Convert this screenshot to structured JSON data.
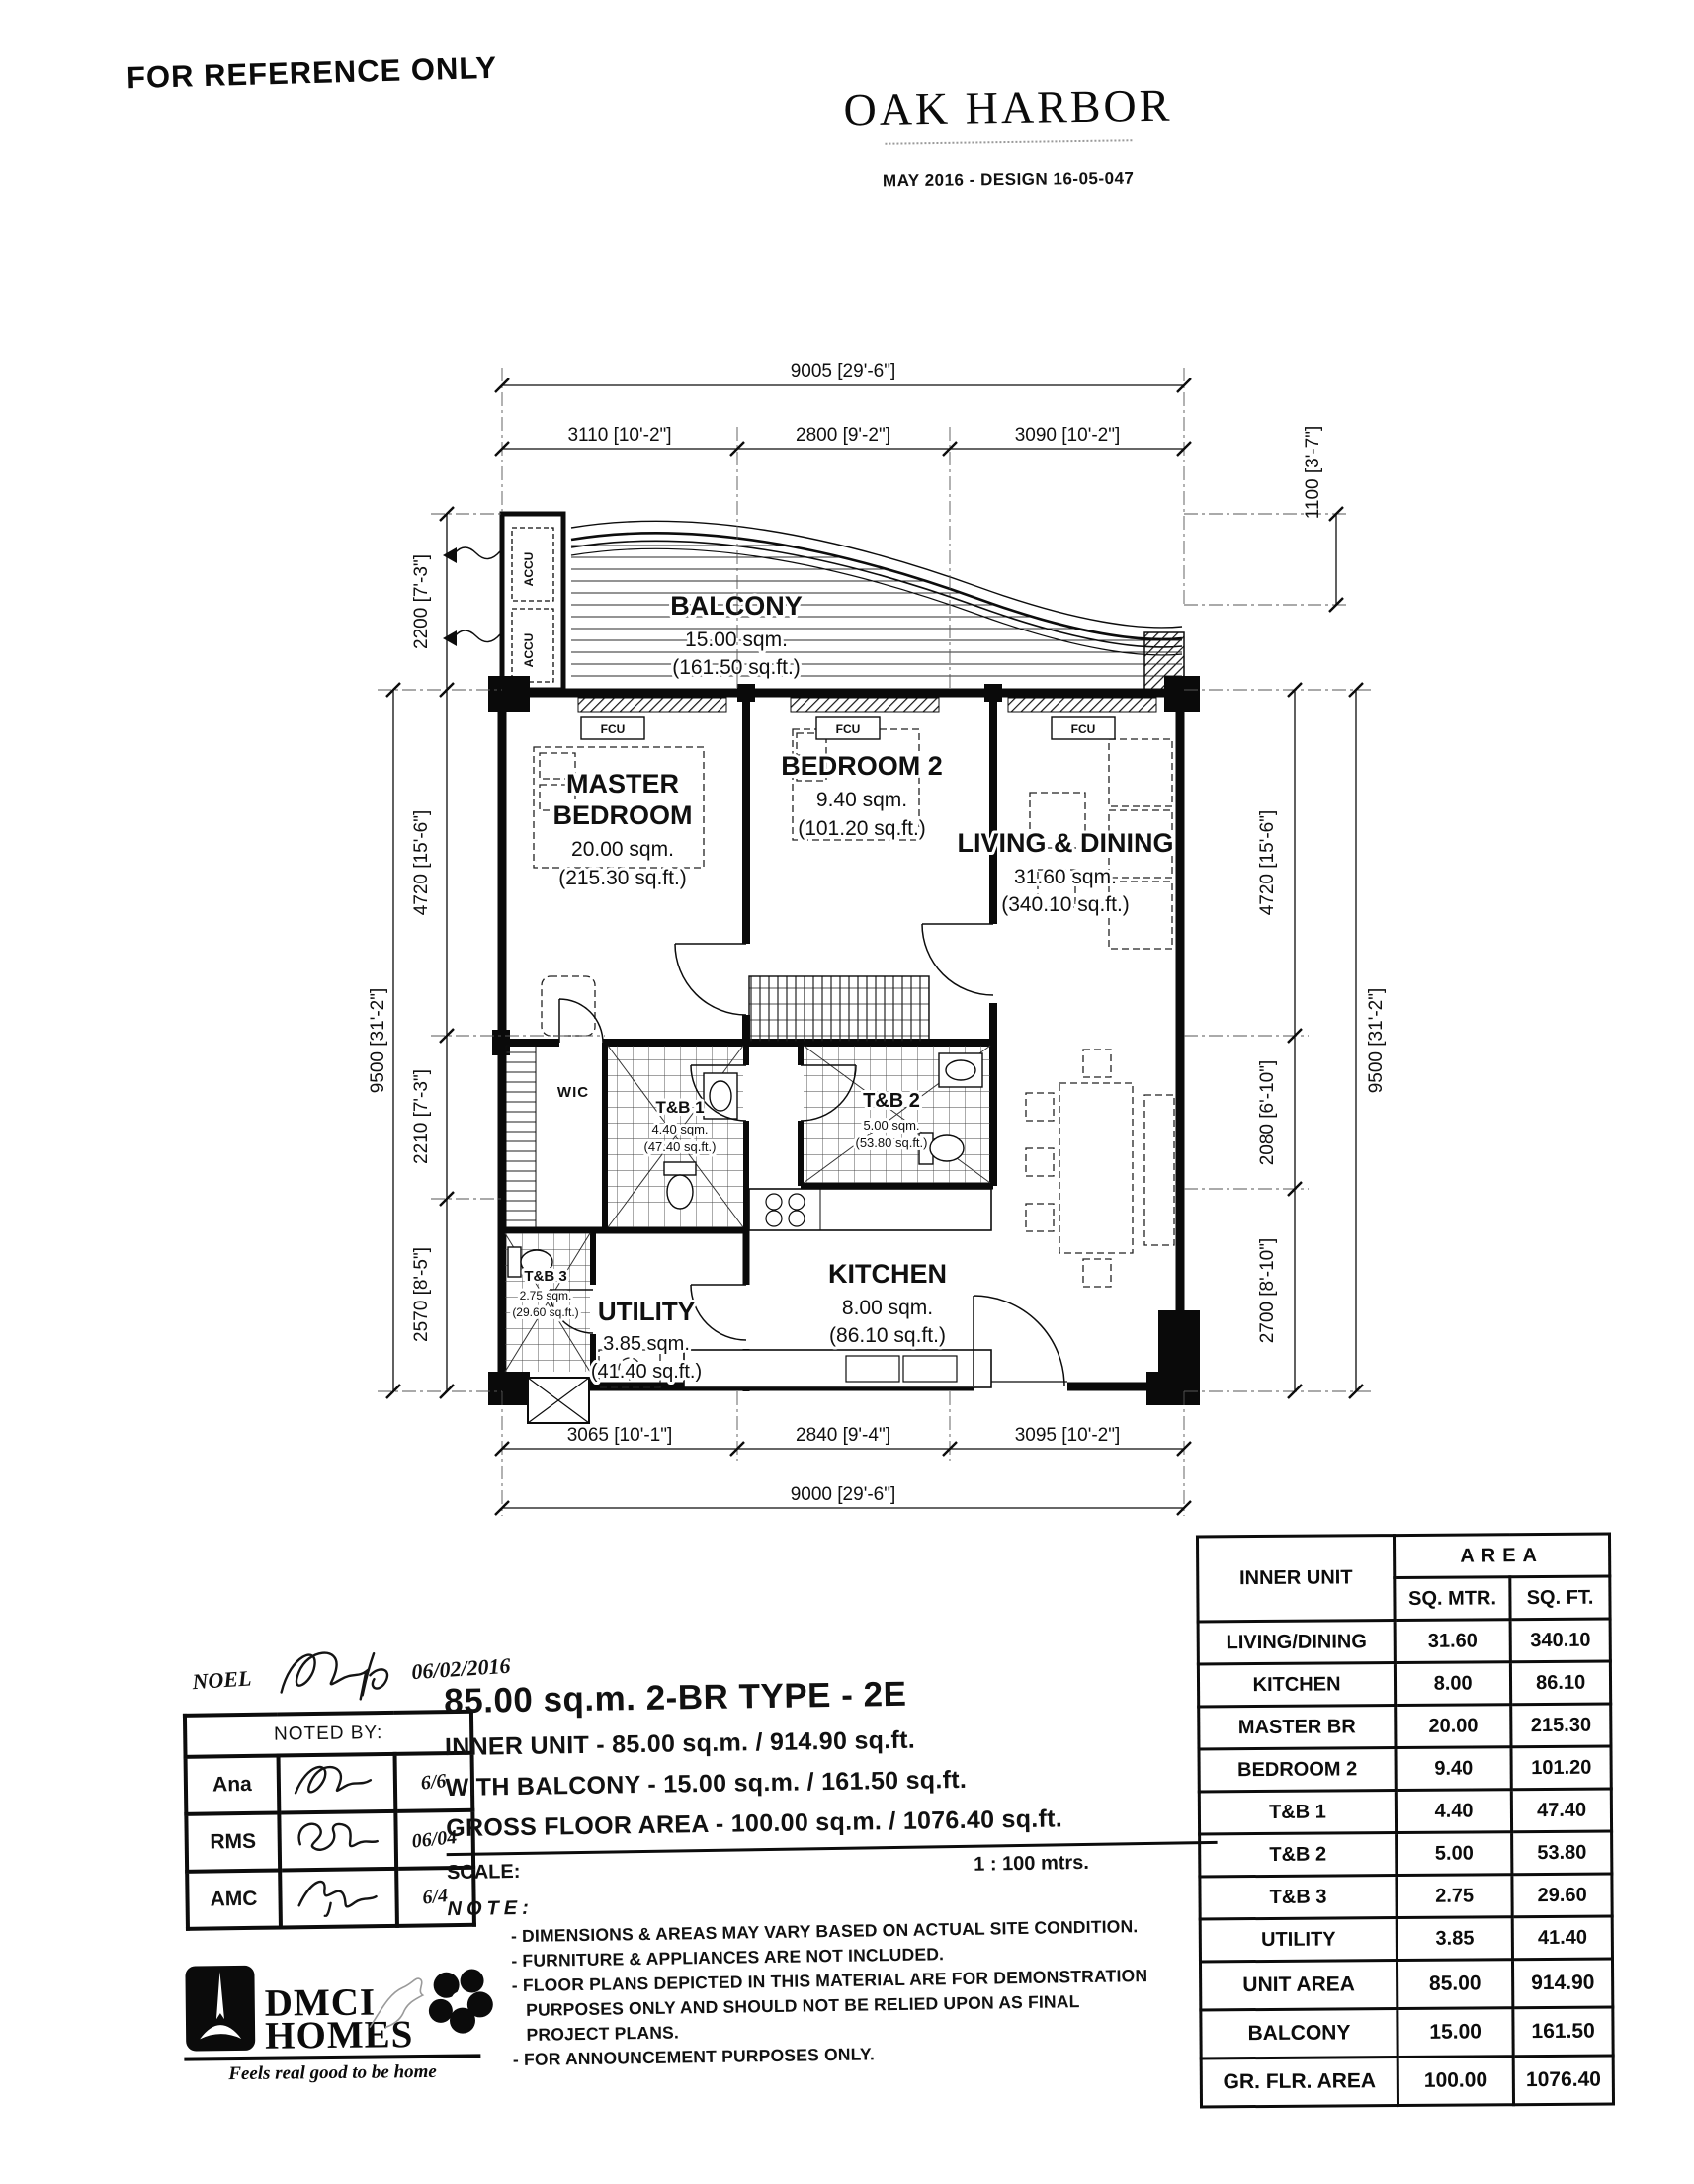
{
  "header": {
    "reference": "FOR REFERENCE ONLY",
    "brand": "OAK HARBOR",
    "design_ref": "MAY 2016 - DESIGN 16-05-047"
  },
  "plan": {
    "room_labels": {
      "balcony": {
        "name": "BALCONY",
        "sqm": "15.00 sqm.",
        "sqft": "(161.50 sq.ft.)"
      },
      "master": {
        "name1": "MASTER",
        "name2": "BEDROOM",
        "sqm": "20.00 sqm.",
        "sqft": "(215.30 sq.ft.)"
      },
      "bedroom2": {
        "name": "BEDROOM 2",
        "sqm": "9.40 sqm.",
        "sqft": "(101.20 sq.ft.)"
      },
      "living": {
        "name": "LIVING & DINING",
        "sqm": "31.60 sqm.",
        "sqft": "(340.10 sq.ft.)"
      },
      "kitchen": {
        "name": "KITCHEN",
        "sqm": "8.00 sqm.",
        "sqft": "(86.10 sq.ft.)"
      },
      "utility": {
        "name": "UTILITY",
        "sqm": "3.85 sqm.",
        "sqft": "(41.40 sq.ft.)"
      },
      "tb1": {
        "name": "T&B 1",
        "sqm": "4.40 sqm.",
        "sqft": "(47.40 sq.ft.)"
      },
      "tb2": {
        "name": "T&B 2",
        "sqm": "5.00 sqm.",
        "sqft": "(53.80 sq.ft.)"
      },
      "tb3": {
        "name": "T&B 3",
        "sqm": "2.75 sqm.",
        "sqft": "(29.60 sq.ft.)"
      },
      "wic": "WIC",
      "accu": "ACCU",
      "fcu": "FCU"
    },
    "dims": {
      "top_total": "9005 [29'-6\"]",
      "top_segments": [
        "3110 [10'-2\"]",
        "2800 [9'-2\"]",
        "3090 [10'-2\"]"
      ],
      "bottom_segments": [
        "3065 [10'-1\"]",
        "2840 [9'-4\"]",
        "3095 [10'-2\"]"
      ],
      "bottom_total": "9000 [29'-6\"]",
      "left_total": "9500 [31'-2\"]",
      "left_segments": [
        "2200 [7'-3\"]",
        "4720 [15'-6\"]",
        "2210 [7'-3\"]",
        "2570 [8'-5\"]"
      ],
      "right_total": "9500 [31'-2\"]",
      "right_segments": [
        "1100 [3'-7\"]",
        "4720 [15'-6\"]",
        "2080 [6'-10\"]",
        "2700 [8'-10\"]"
      ]
    }
  },
  "area_table": {
    "col1_header": "INNER UNIT",
    "area_header": "AREA",
    "sub_headers": [
      "SQ. MTR.",
      "SQ. FT."
    ],
    "rows": [
      {
        "label": "LIVING/DINING",
        "sqm": "31.60",
        "sqft": "340.10"
      },
      {
        "label": "KITCHEN",
        "sqm": "8.00",
        "sqft": "86.10"
      },
      {
        "label": "MASTER BR",
        "sqm": "20.00",
        "sqft": "215.30"
      },
      {
        "label": "BEDROOM 2",
        "sqm": "9.40",
        "sqft": "101.20"
      },
      {
        "label": "T&B 1",
        "sqm": "4.40",
        "sqft": "47.40"
      },
      {
        "label": "T&B 2",
        "sqm": "5.00",
        "sqft": "53.80"
      },
      {
        "label": "T&B 3",
        "sqm": "2.75",
        "sqft": "29.60"
      },
      {
        "label": "UTILITY",
        "sqm": "3.85",
        "sqft": "41.40"
      },
      {
        "label": "UNIT AREA",
        "sqm": "85.00",
        "sqft": "914.90"
      },
      {
        "label": "BALCONY",
        "sqm": "15.00",
        "sqft": "161.50"
      },
      {
        "label": "GR. FLR. AREA",
        "sqm": "100.00",
        "sqft": "1076.40"
      }
    ]
  },
  "noted_by": {
    "title": "NOTED BY:",
    "annotation": {
      "name": "NOEL",
      "date": "06/02/2016"
    },
    "rows": [
      {
        "name": "Ana",
        "date": "6/6"
      },
      {
        "name": "RMS",
        "date": "06/04"
      },
      {
        "name": "AMC",
        "date": "6/4"
      }
    ]
  },
  "summary": {
    "title": "85.00 sq.m. 2-BR TYPE - 2E",
    "lines": [
      "INNER UNIT - 85.00 sq.m. / 914.90 sq.ft.",
      "WITH BALCONY - 15.00 sq.m. / 161.50 sq.ft.",
      "GROSS FLOOR AREA - 100.00 sq.m. / 1076.40 sq.ft."
    ],
    "scale_label": "SCALE:",
    "scale_value": "1 : 100 mtrs.",
    "note_label": "NOTE:",
    "notes": [
      "DIMENSIONS & AREAS MAY VARY BASED ON ACTUAL SITE CONDITION.",
      "FURNITURE & APPLIANCES ARE NOT INCLUDED.",
      "FLOOR PLANS DEPICTED IN THIS MATERIAL ARE FOR DEMONSTRATION PURPOSES ONLY AND SHOULD NOT BE RELIED UPON AS FINAL PROJECT PLANS.",
      "FOR ANNOUNCEMENT PURPOSES ONLY."
    ]
  },
  "footer_logo": {
    "name_line1": "DMCI",
    "name_line2": "HOMES",
    "tagline": "Feels real good to be home"
  }
}
